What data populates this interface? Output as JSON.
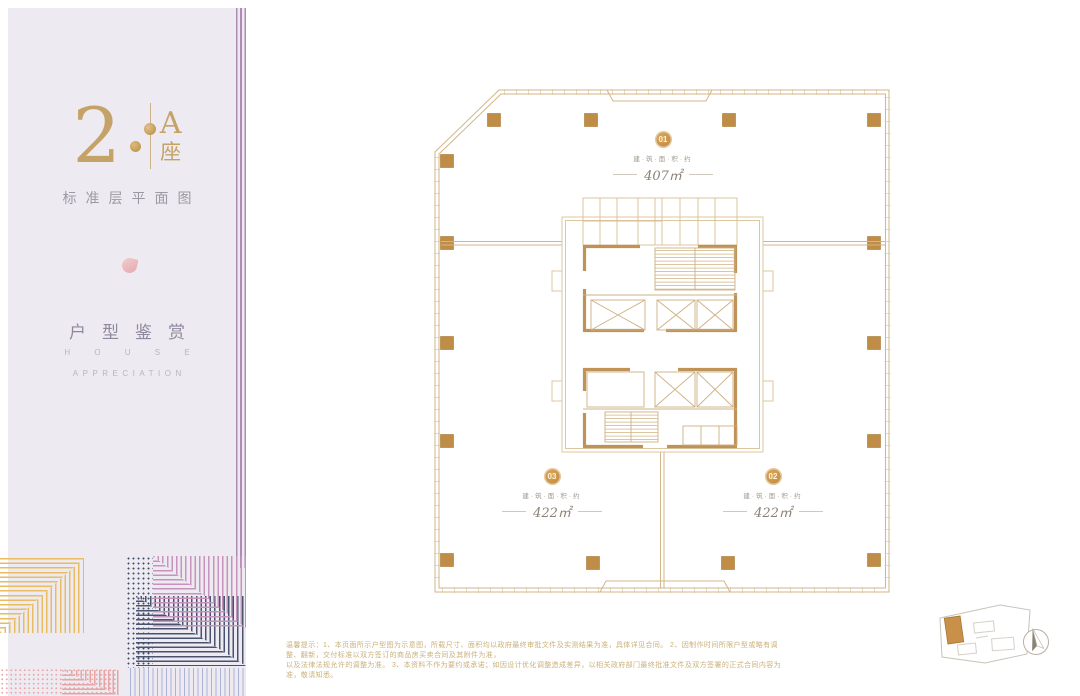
{
  "panel": {
    "block_number": "2",
    "building_label": "A座",
    "plan_caption": "标准层平面图",
    "section_title": "户型鉴赏",
    "section_en_line1": "H O U S E",
    "section_en_line2": "APPRECIATION"
  },
  "plan": {
    "title": "A座标准层平面图",
    "units": [
      {
        "id": "01",
        "area_caption": "建·筑·面·积·约",
        "area": "407㎡"
      },
      {
        "id": "03",
        "area_caption": "建·筑·面·积·约",
        "area": "422㎡"
      },
      {
        "id": "02",
        "area_caption": "建·筑·面·积·约",
        "area": "422㎡"
      }
    ]
  },
  "footer": {
    "disclaimer_line1": "温馨提示：1、本页面所示户型图为示意图，所载尺寸、面积均以政府最终审批文件及实测结果为准，具体详见合同。 2、因制作时间所限户型或略有调整、翻新，交付标准以双方签订的商品房买卖合同及其附件为准，",
    "disclaimer_line2": "以及法律法规允许的调整为准。 3、本资料不作为要约或承诺；如因设计优化调整造成差异，以相关政府部门最终批准文件及双方签署的正式合同内容为准，敬请知悉。"
  },
  "colors": {
    "brand_gold": "#c5a267",
    "plan_line": "#d2b688",
    "plan_wall": "#bf9257",
    "plan_column": "#c08d49",
    "panel_bg": "#edebf1",
    "stripe_purple": "#b08bb1",
    "area_text": "#8b8275",
    "disclaimer_text": "#cbb078",
    "pattern_gold": "#e9bc62",
    "pattern_mauve": "#c793bd",
    "pattern_navy": "#49536e",
    "pattern_pink": "#e8a3a3",
    "pattern_lavender": "#aab3d3"
  }
}
